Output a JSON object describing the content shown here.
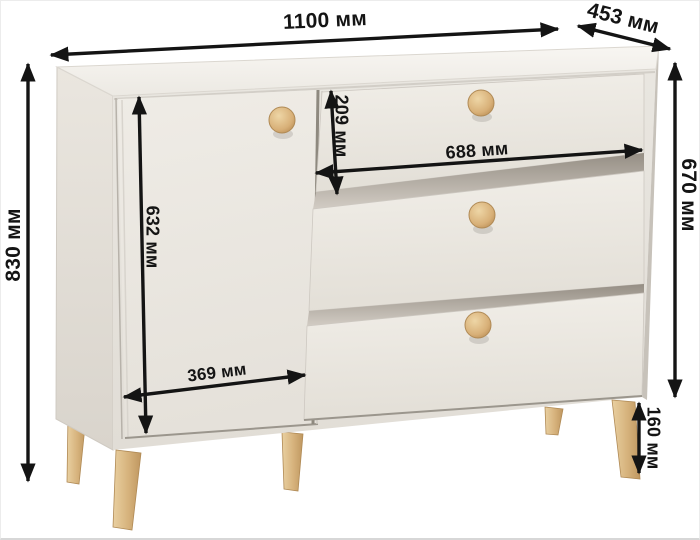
{
  "diagram": {
    "product": "chest of drawers with door and three drawers",
    "unit": "мм",
    "dimensions": {
      "width": {
        "label": "1100 мм",
        "value": 1100
      },
      "depth": {
        "label": "453 мм",
        "value": 453
      },
      "total_height": {
        "label": "830 мм",
        "value": 830
      },
      "body_height": {
        "label": "670 мм",
        "value": 670
      },
      "door_height": {
        "label": "632 мм",
        "value": 632
      },
      "door_width": {
        "label": "369 мм",
        "value": 369
      },
      "drawer_height": {
        "label": "209 мм",
        "value": 209
      },
      "drawer_width": {
        "label": "688 мм",
        "value": 688
      },
      "leg_height": {
        "label": "160 мм",
        "value": 160
      }
    },
    "colors": {
      "dimension_lines": "#141414",
      "cabinet_body": "#e9e6e0",
      "cabinet_top": "#f6f4f0",
      "wood_knobs_and_legs": "#d5ad76",
      "background": "#ffffff"
    }
  }
}
